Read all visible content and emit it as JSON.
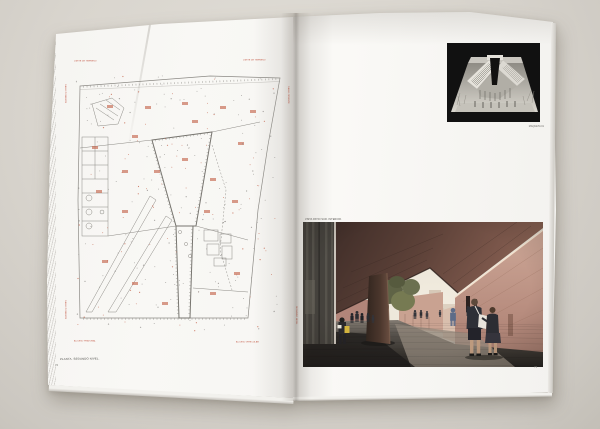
{
  "left_page": {
    "plan_caption": "PLANTA. SEGUNDO NIVEL.",
    "page_number": "72",
    "labels": {
      "top_left": "LIMITE DE TERRENO",
      "top_right": "LIMITE DE TERRENO",
      "bottom_left": "ACCESO PEATONAL",
      "bottom_right": "ACCESO VEHICULAR",
      "side_left": "CALLE PONIENTE",
      "side_right": "CALLE ORIENTE"
    }
  },
  "right_page": {
    "view_caption": "VISTA PATIO SUR. INTERIOR.",
    "model_caption": "MAQUETA 01",
    "page_number": "73",
    "margin_label": "SEGUNDO NIVEL"
  },
  "colors": {
    "plan_annotation_red": "#c4674f",
    "plan_line_gray": "#8e8c88",
    "brick_ceiling": "#5d4238",
    "terracotta_wall": "#c29788",
    "ground_dark": "#37342f",
    "model_background": "#0d0d0d"
  }
}
